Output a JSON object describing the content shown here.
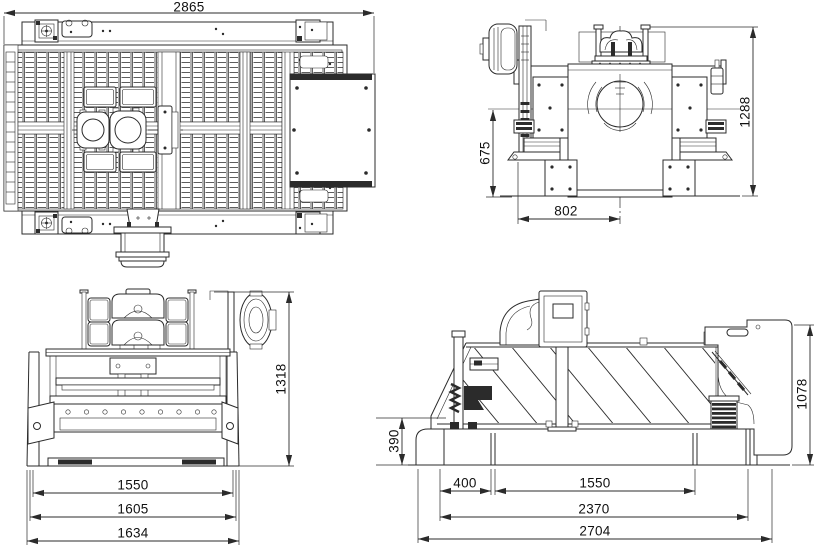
{
  "colors": {
    "background": "#ffffff",
    "line": "#2b2b2b",
    "text": "#111111"
  },
  "views": {
    "top": {
      "label": "top-view",
      "dims": {
        "overall_length": "2865"
      }
    },
    "end": {
      "label": "end-view",
      "dims": {
        "overall_height": "1288",
        "deck_height": "675",
        "base_half_width": "802"
      }
    },
    "front": {
      "label": "front-view",
      "dims": {
        "overall_height": "1318",
        "base_width_inner": "1550",
        "base_width_mid": "1605",
        "base_width_outer": "1634"
      }
    },
    "side": {
      "label": "side-view",
      "dims": {
        "overall_height": "1078",
        "discharge_height": "390",
        "feed_offset": "400",
        "support_span": "1550",
        "skid_length": "2370",
        "overall_length": "2704"
      }
    }
  }
}
